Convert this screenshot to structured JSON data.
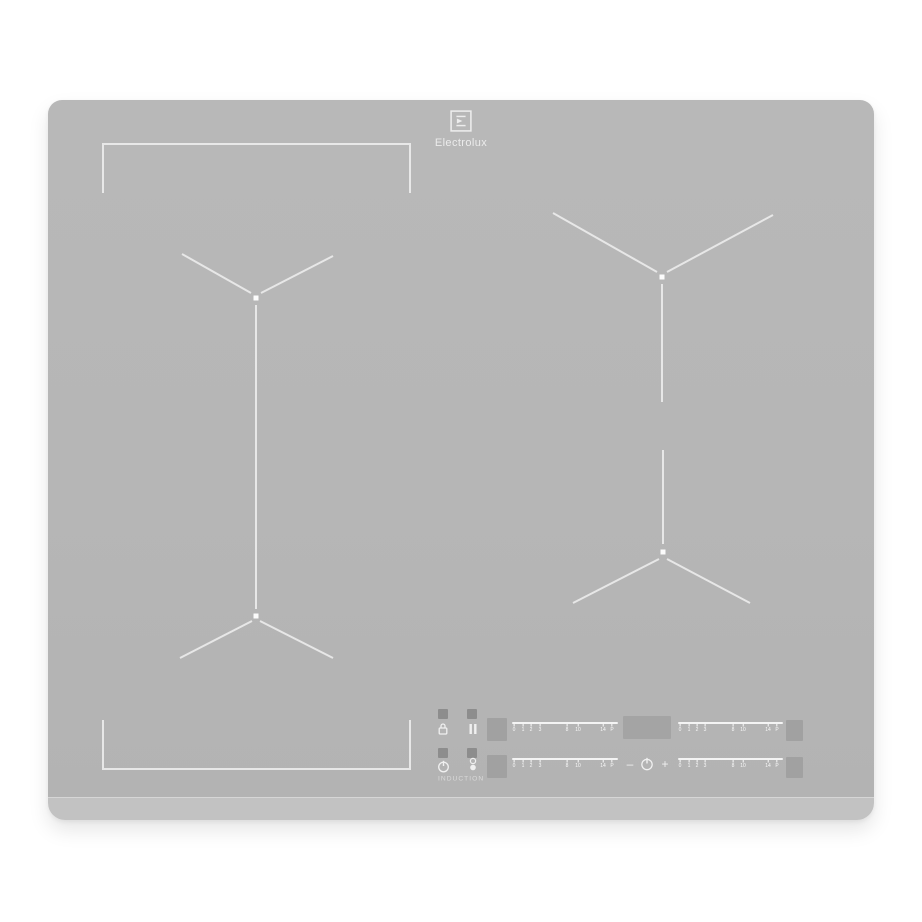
{
  "brand": {
    "name": "Electrolux"
  },
  "panel": {
    "induction_label": "INDUCTION",
    "minus_label": "–",
    "plus_label": "+",
    "slider_ticks": [
      {
        "label": "0",
        "pos": 2
      },
      {
        "label": "1",
        "pos": 10
      },
      {
        "label": "2",
        "pos": 18
      },
      {
        "label": "3",
        "pos": 26
      },
      {
        "label": "8",
        "pos": 52
      },
      {
        "label": "10",
        "pos": 62
      },
      {
        "label": "14",
        "pos": 86
      },
      {
        "label": "P",
        "pos": 94
      }
    ],
    "icons": {
      "lock": "lock-icon",
      "pause": "pause-icon",
      "power": "power-icon",
      "hob2hood": "hob2hood-icon",
      "main_power": "power-icon"
    }
  },
  "colors": {
    "page-bg": "#ffffff",
    "surface": "#b6b6b6",
    "front-edge": "#c2c2c2",
    "touch-pad": "#a1a1a1",
    "indicator": "#8d8d8d",
    "display": "#a4a4a4",
    "marking": "#eeeeee",
    "panel-text": "#e0e0e0"
  }
}
